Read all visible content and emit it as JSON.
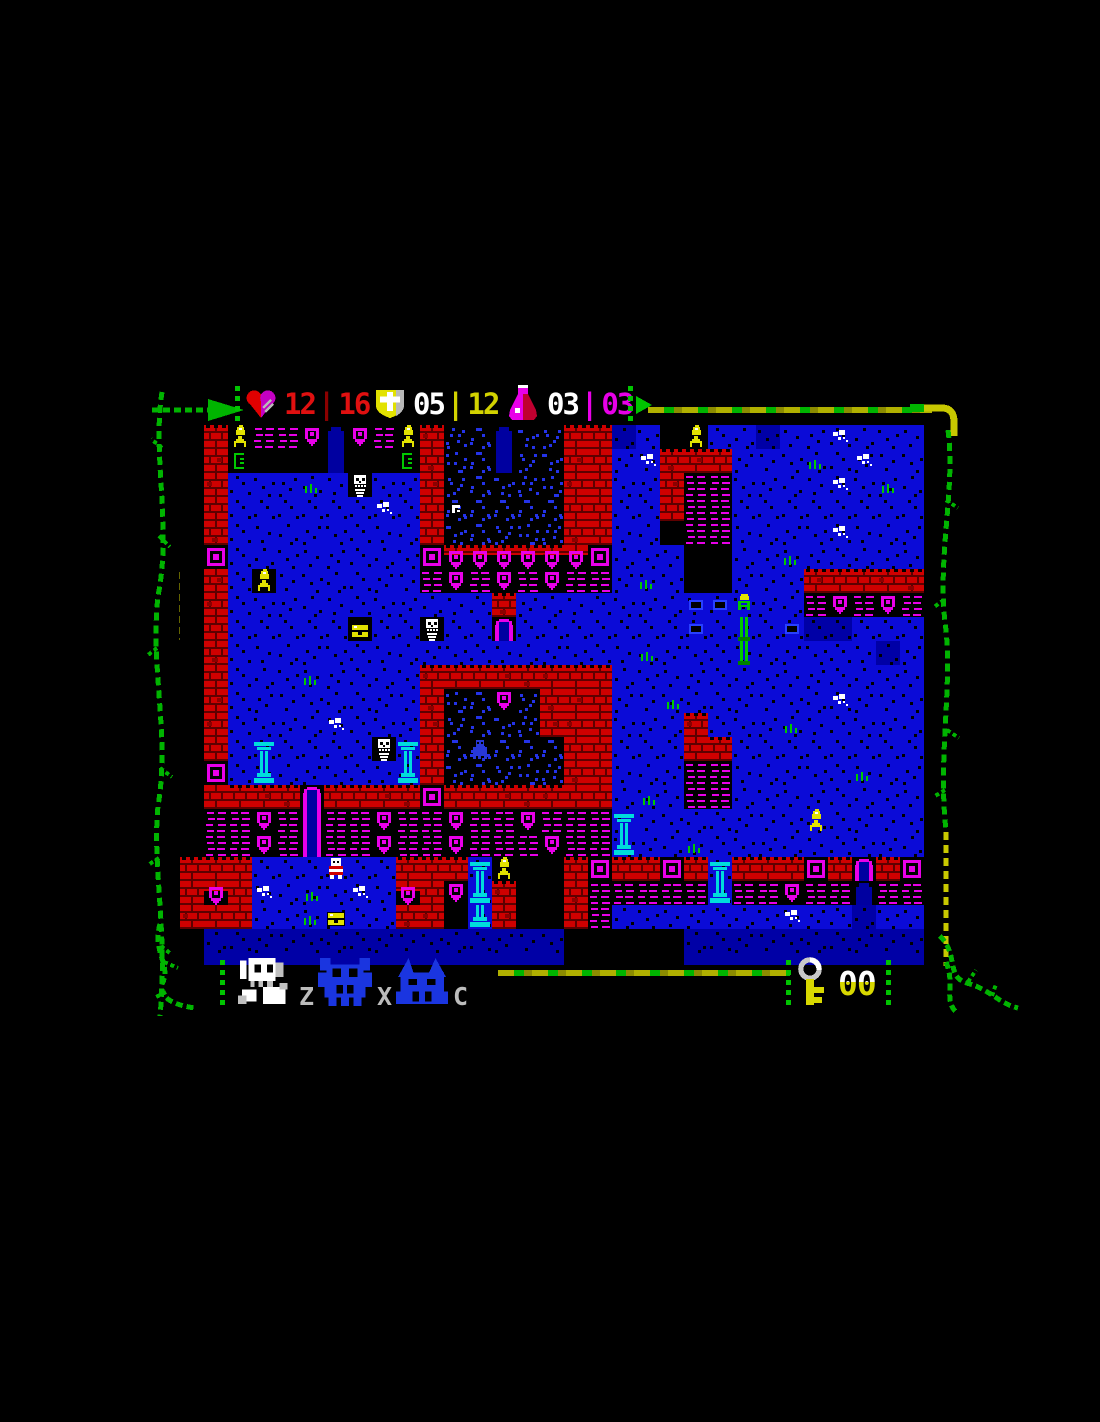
{
  "hud": {
    "stats": [
      {
        "name": "health",
        "icon": "heart-icon",
        "current": "12",
        "sep": "|",
        "max": "16",
        "color": "#e01010"
      },
      {
        "name": "armor",
        "icon": "shield-icon",
        "current": "05",
        "sep": "|",
        "max": "12",
        "color": "#d2d200"
      },
      {
        "name": "potions",
        "icon": "flask-icon",
        "current": "03",
        "sep": "|",
        "max": "03",
        "color": "#e800e8"
      }
    ]
  },
  "party": {
    "members": [
      {
        "name": "knight",
        "key": "Z",
        "active": true
      },
      {
        "name": "demon",
        "key": "X",
        "active": false
      },
      {
        "name": "beast",
        "key": "C",
        "active": false
      }
    ]
  },
  "inventory": {
    "keys": "00"
  },
  "map": {
    "tile_size": 24,
    "cols": 31,
    "rows": 22,
    "palette": {
      "floor": "#0b0bd7",
      "floor_dark": "#0000a6",
      "dark_dot": "#2433e8",
      "brick": "#cf0000",
      "brick_dark": "#8c0000",
      "mortar": "#5e0000",
      "magenta": "#e800e8",
      "yellow": "#e2e200",
      "cyan": "#00dcdc",
      "green": "#00c800",
      "green_dark": "#008000",
      "white": "#ffffff",
      "ghost_blue": "#2838d8",
      "arch_blue": "#0000a0"
    },
    "legend": {
      ".": "void",
      "b": "floor",
      "D": "floor-dark",
      "d": "dark-room-floor",
      "g": "grass",
      "w": "bone-scatter",
      "x": "floor-hatch",
      "r": "brick-wall",
      "q": "wall-ornament-square",
      "s": "wall-with-shield",
      "o": "ornament-stripes",
      "f": "shield-ornament",
      "t": "torch",
      "u": "torch-on-floor",
      "T": "green-torch",
      "E": "green-pedestal",
      "v": "green-sconce",
      "c": "pillar-top",
      "C": "pillar-base",
      "k": "skeleton-enemy",
      "y": "chest",
      "Y": "chest-dark",
      "i": "item",
      "P": "player-knight",
      "G": "ghost-enemy",
      "a": "magenta-arch",
      "A": "dark-arch"
    },
    "grid": [
      ".rtoofAfotrddAddrrDb.tbbDbbwbbb",
      ".rv...A..vrddAddrrbwrrrbbbgbwbb",
      ".rbbbgbkbbrdddddrrbbroobbbbwbgb",
      ".rbbbbbbwbriddddrrbbroobbbbbbbb",
      ".rbbbbbbbbrdddddrrbb.oobbbbwbbb",
      ".qbbbbbbbbqssssssqbbb..bbgbbbbb",
      ".rbtbbbbbbofofofoobgb..bbbrrrrr",
      ".rbbbbbbbbbbbrbbbbbbbxxTbbofofo",
      ".rbbbbbYbbkbbabbbbbbbxbEbxDDbbb",
      ".rbbbbbbbbbbbbbbbbbgbbbEbbbbbDb",
      ".rbbbgbbbbrrrrrrrrbbbbbbbbbbbbb",
      ".rbbbbbbbbrddfdrrrbbgbbbbbbwbbb",
      ".rbbbbwbbbrddddrrrbbbrbbbgbbbbb",
      ".rbcbbbbkcrdGdddrrbbbrrbbbbbbbb",
      ".qbCbbbbbCrdddddrrbbboobbbbbgbb",
      ".rrrrarrrrqrrrrrrrbgboobbbbbbbb",
      ".oofoaoofoofoofooocbbbbbbbubbbb",
      ".oofoaoofoofooofooCbbgbbbbbbbbb",
      "rrrbbbPbbrrrct..rqrrqrcrrrqrarq",
      "rsrwbgbwbsrfCr..roooooCoofooAoo",
      "rrrbbgybbrr.Cr..robbbbbbbwbbDbb",
      ".DDDDDDDDDDDDDDD.....DDDDDDDDDD"
    ]
  }
}
